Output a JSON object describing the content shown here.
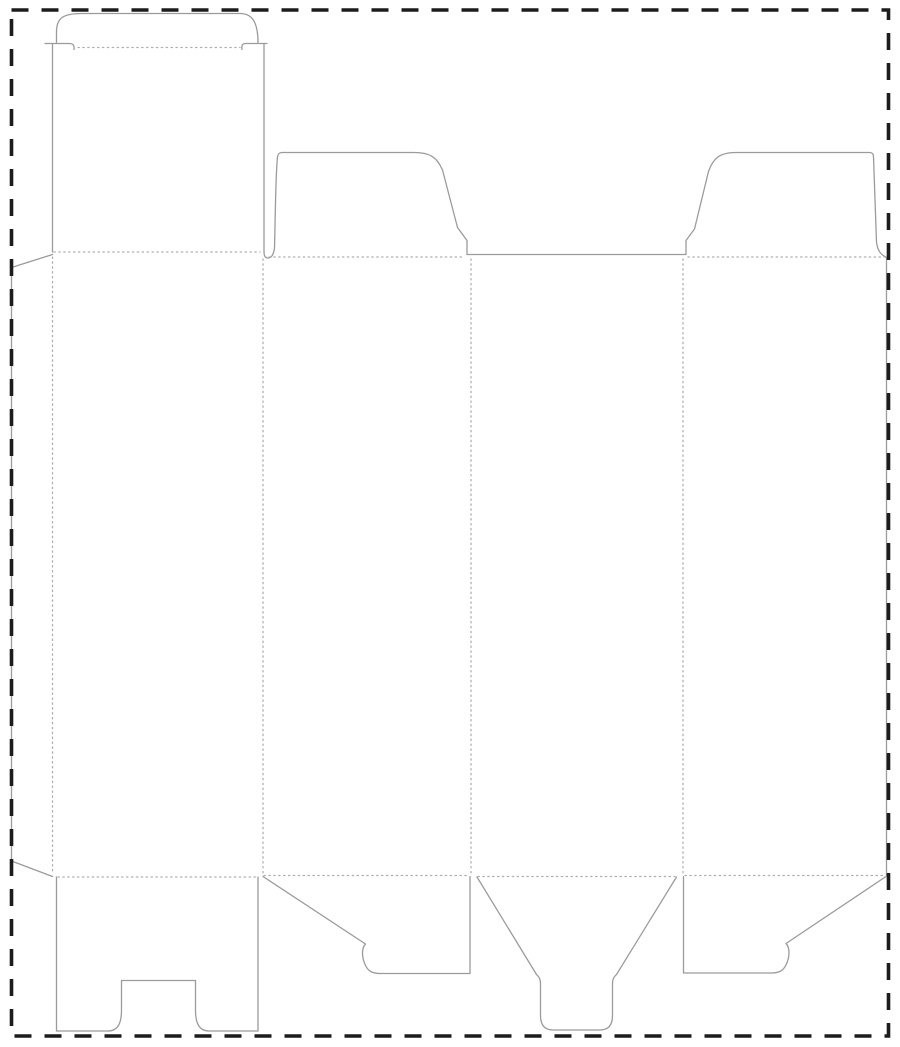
{
  "meta": {
    "description": "folding-carton die-cut template with tuck top and snap-lock bottom",
    "canvas": {
      "width": 900,
      "height": 1047,
      "background": "#ffffff"
    }
  },
  "styles": {
    "cut": {
      "color": "#9b9b9b",
      "width": 1.3,
      "dash": ""
    },
    "fold": {
      "color": "#aeaeae",
      "width": 1.3,
      "dash": "1.3 3.6"
    },
    "boundary": {
      "color": "#1c1c1c",
      "width": 3.6,
      "dash": "17 13"
    }
  },
  "boundary": {
    "x": 11.5,
    "y": 10,
    "width": 877,
    "height": 1026
  },
  "cut_lines": [
    {
      "name": "tuck-flap-outline",
      "path": "M 56.5 43.5 L 56.5 32 C 56.5 18 63 13.5 82 13.5 L 240 13.5 C 252 13.5 258 22 258 42.5"
    },
    {
      "name": "tuck-lock-slit-left",
      "path": "M 45 43.5 L 69 43.5 C 73.5 43.5 74.5 45.5 74 49.5"
    },
    {
      "name": "tuck-lock-slit-right",
      "path": "M 267 43.5 L 246 43.5 C 242 43.5 241.5 45.5 242 49.5"
    },
    {
      "name": "lid-panel-left-edge",
      "path": "M 52.5 43.5 L 52.5 252"
    },
    {
      "name": "lid-panel-right-edge",
      "path": "M 264 43.5 L 264 252"
    },
    {
      "name": "glue-flap-outline",
      "path": "M 52.5 254.5 L 11.5 267.5 L 11.5 861 L 52.5 876.5"
    },
    {
      "name": "dust-flap-left-outline",
      "path": "M 264 252 C 264 256.5 265.5 258 268 258 C 271 258 273.5 255.5 274.5 248 C 275.5 212 275.5 176 277.5 157 C 278 153.5 279.5 152.5 282 152.5 L 414 152.5 C 430.5 152.5 437 157.5 442.5 170 L 457.5 227.5 L 467 240.5 L 467 254.5"
    },
    {
      "name": "panel3-top-edge",
      "path": "M 467 254.5 L 686 254.5"
    },
    {
      "name": "dust-flap-right-outline",
      "path": "M 686 254.5 L 686 240.5 L 694.5 229 L 708.5 171.5 C 713 158.5 719.5 152.5 736 152.5 L 869.5 152.5 C 872.5 152.5 873.5 154 873.5 157 L 876.5 242 C 877.5 250.5 880.5 254.5 886.5 257.5"
    },
    {
      "name": "panel4-right-edge",
      "path": "M 886.5 257.5 L 886.5 875.5"
    },
    {
      "name": "bottom-lock-panel-outline",
      "path": "M 56.5 877 L 56.5 1031 L 108 1031 C 117.5 1031 121.5 1024 121.5 1010 L 121.5 980.5 L 195.5 980.5 L 195.5 1010 C 195.5 1024 199.5 1031 209 1031 L 258 1031 L 258 877"
    },
    {
      "name": "bottom-flap-left-outline",
      "path": "M 263 876.5 L 365.5 944 C 361.5 948 361.5 957 365.5 965.5 C 368.5 971.5 372.5 973.5 381 973.5 L 470 973.5 L 470 876.5"
    },
    {
      "name": "bottom-tongue-outline",
      "path": "M 477 877 L 536.5 974.5 C 539.5 977 540.5 979.5 540.5 984 L 540.5 1015.5 C 540.5 1025.5 545 1030 553 1030 L 600 1030 C 608 1030 612.5 1025.5 612.5 1015.5 L 612.5 984 C 612.5 979.5 613.5 977 616.5 974.5 L 676.5 877"
    },
    {
      "name": "bottom-flap-right-outline",
      "path": "M 886 876.5 L 786 943.5 C 790 947.5 790 956.5 786 965 C 783 971 779 973 770.5 973 L 683.5 973 L 683.5 876.5"
    }
  ],
  "fold_lines": [
    {
      "name": "tuck-flap-fold",
      "path": "M 78 47.5 L 240 47.5"
    },
    {
      "name": "lid-panel-fold",
      "path": "M 54 252 L 260 252"
    },
    {
      "name": "dust-flap-left-fold",
      "path": "M 269 257 L 464 257"
    },
    {
      "name": "dust-flap-right-fold",
      "path": "M 688 257 L 884 257"
    },
    {
      "name": "glue-flap-fold",
      "path": "M 52.5 257 L 52.5 874"
    },
    {
      "name": "panel1-panel2-fold",
      "path": "M 263 259 L 263 873"
    },
    {
      "name": "panel2-panel3-fold",
      "path": "M 471 259 L 471 873"
    },
    {
      "name": "panel3-panel4-fold",
      "path": "M 683 259 L 683 873"
    },
    {
      "name": "panel1-bottom-fold",
      "path": "M 58 877 L 256 877"
    },
    {
      "name": "panel2-bottom-fold",
      "path": "M 264 875.5 L 469 875.5"
    },
    {
      "name": "panel3-bottom-fold",
      "path": "M 478 876.5 L 675 876.5"
    },
    {
      "name": "panel4-bottom-fold",
      "path": "M 685 875.5 L 884 875.5"
    }
  ]
}
